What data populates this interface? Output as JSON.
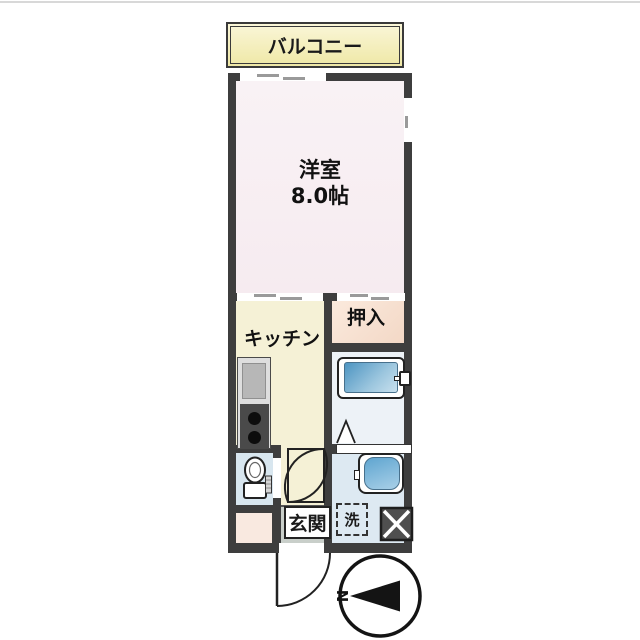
{
  "page": {
    "type": "apartment-floor-plan"
  },
  "rooms": {
    "balcony": {
      "label": "バルコニー"
    },
    "main_room": {
      "label": "洋室",
      "size": "8.0帖"
    },
    "kitchen": {
      "label": "キッチン"
    },
    "closet": {
      "label": "押入"
    },
    "entrance": {
      "label": "玄関"
    },
    "laundry_space": {
      "label": "洗"
    }
  },
  "compass": {
    "label": "N",
    "points": "left"
  },
  "fixtures": [
    "kitchen-sink",
    "gas-stove-2-burner",
    "bathtub-with-faucet",
    "washbasin",
    "toilet",
    "washing-machine-space",
    "pipe-space-x-box",
    "entrance-swing-door",
    "interior-hinged-door",
    "folding-bath-door",
    "sliding-window-top",
    "sliding-door-kitchen",
    "sliding-door-closet",
    "side-window"
  ],
  "colors": {
    "wall": "#3e3e3e",
    "main_room_floor": "#f8eff3",
    "kitchen_floor": "#f5f1d6",
    "balcony_fill": "#f2ecb4",
    "closet_fill": "#f7e2d2",
    "bath_floor": "#edf2f7",
    "washroom_floor": "#dde9f2",
    "toilet_floor": "#d8e6ef",
    "entrance_floor": "#c9cfca",
    "alcove_floor": "#f9e9e0",
    "bathtub_blue": "#4d95c2",
    "outline": "#222222"
  }
}
